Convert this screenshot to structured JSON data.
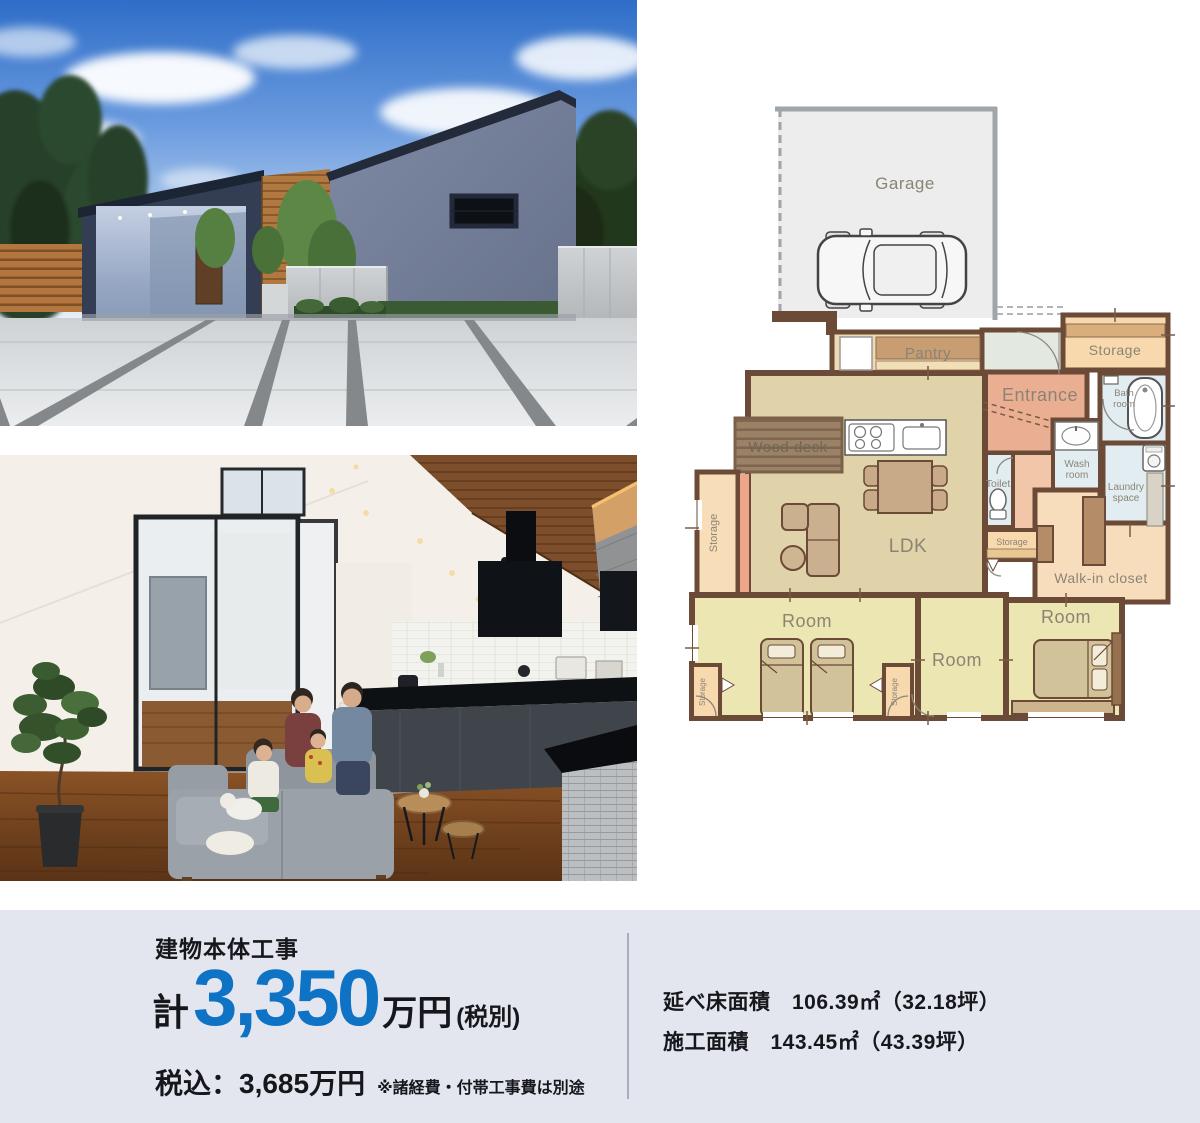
{
  "floor_plan": {
    "labels": {
      "garage": "Garage",
      "pantry": "Pantry",
      "storage": "Storage",
      "entrance": "Entrance",
      "bath_room": [
        "Bath",
        "room"
      ],
      "wash_room": [
        "Wash",
        "room"
      ],
      "laundry_space": [
        "Laundry",
        "space"
      ],
      "toilet": "Toilet",
      "ldk": "LDK",
      "wood_deck": "Wood deck",
      "walk_in_closet": "Walk-in closet",
      "room": "Room"
    },
    "colors": {
      "wall": "#6b4a37",
      "ldk_floor": "#e0d2a9",
      "bedroom_floor": "#ece6b2",
      "entrance_floor": "#eaaf92",
      "storage_fill": "#f7d9ad",
      "wet_area_fill": "#e2edf2",
      "garage_fill": "#ededed"
    }
  },
  "price_panel": {
    "title": "建物本体工事",
    "prefix": "計",
    "amount": "3,350",
    "unit": "万円",
    "tax_label": "(税別)",
    "tax_included": "税込：3,685万円",
    "note": "※諸経費・付帯工事費は別途",
    "accent_color": "#0e72c5"
  },
  "area_panel": {
    "total_floor_area": "延べ床面積　106.39㎡（32.18坪）",
    "construction_area": "施工面積　143.45㎡（43.39坪）"
  }
}
